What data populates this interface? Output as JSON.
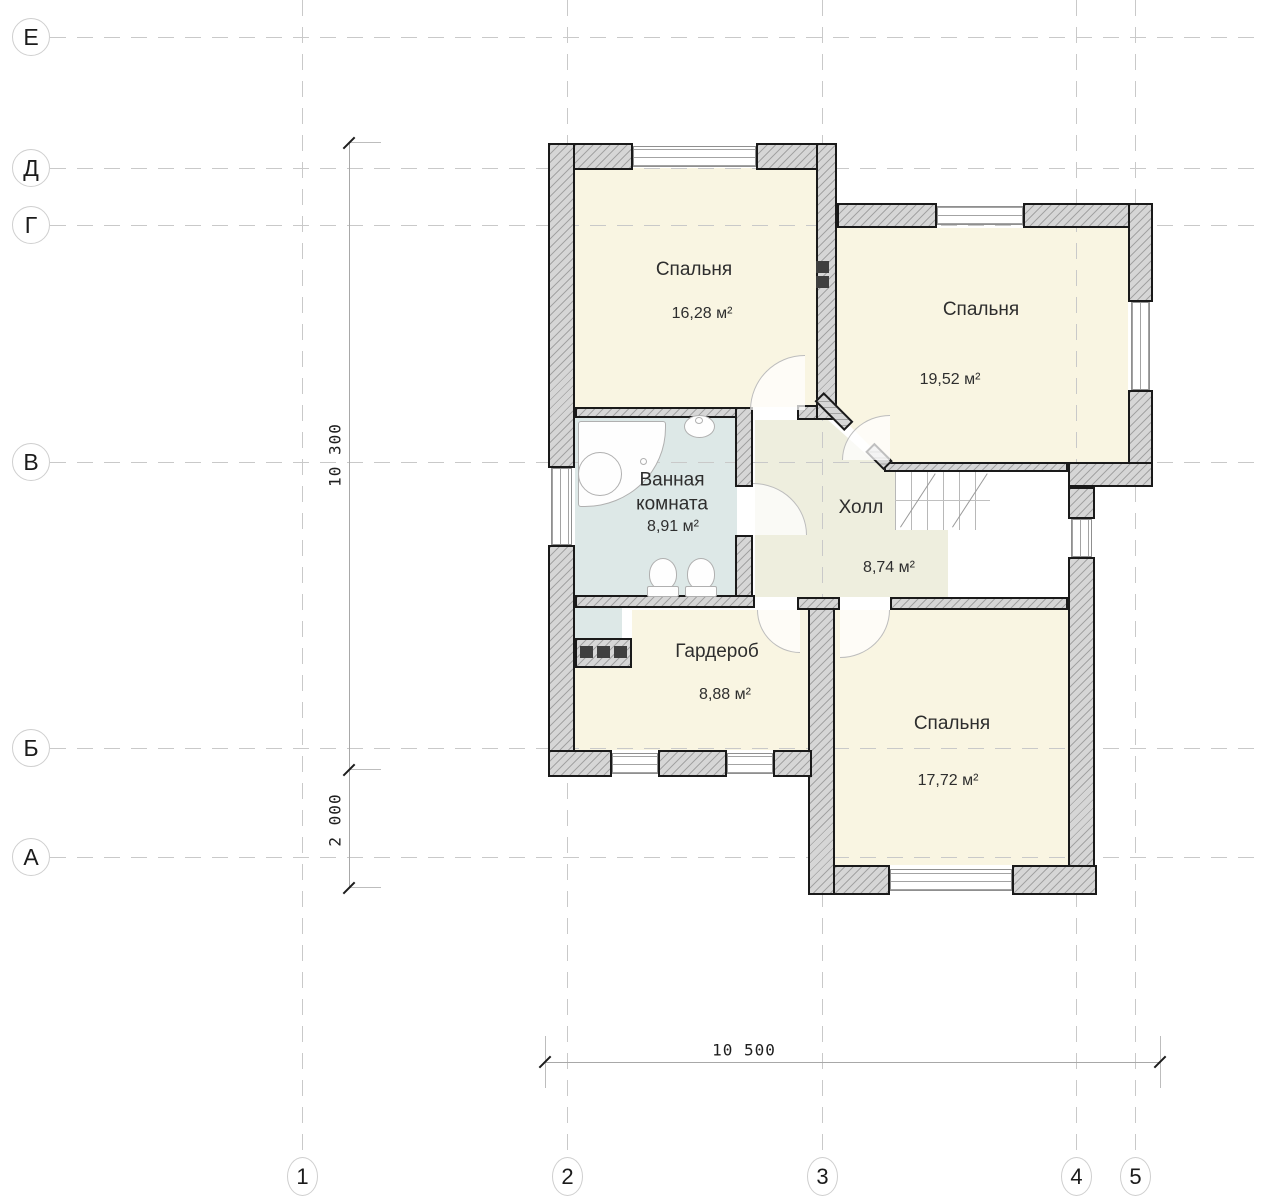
{
  "grid": {
    "rows": [
      {
        "label": "Е"
      },
      {
        "label": "Д"
      },
      {
        "label": "Г"
      },
      {
        "label": "В"
      },
      {
        "label": "Б"
      },
      {
        "label": "А"
      }
    ],
    "cols": [
      {
        "label": "1"
      },
      {
        "label": "2"
      },
      {
        "label": "3"
      },
      {
        "label": "4"
      },
      {
        "label": "5"
      }
    ]
  },
  "dimensions": {
    "vertical_upper": "10 300",
    "vertical_lower": "2 000",
    "horizontal_bottom": "10 500"
  },
  "rooms": [
    {
      "id": "bedroom-1",
      "name": "Спальня",
      "area": "16,28 м²"
    },
    {
      "id": "bedroom-2",
      "name": "Спальня",
      "area": "19,52 м²"
    },
    {
      "id": "bathroom",
      "name": "Ванная комната",
      "area": "8,91 м²"
    },
    {
      "id": "hall",
      "name": "Холл",
      "area": "8,74 м²"
    },
    {
      "id": "wardrobe",
      "name": "Гардероб",
      "area": "8,88 м²"
    },
    {
      "id": "bedroom-3",
      "name": "Спальня",
      "area": "17,72 м²"
    }
  ],
  "colors": {
    "room_fill": "#f9f5e2",
    "bathroom_fill": "#dde8e7",
    "hall_fill": "#eeeede",
    "wall_fill": "#d6d6d6",
    "wall_outline": "#1a1a1a",
    "grid_line": "#c9c9c9",
    "vent_shaft": "#3f3f3f"
  }
}
